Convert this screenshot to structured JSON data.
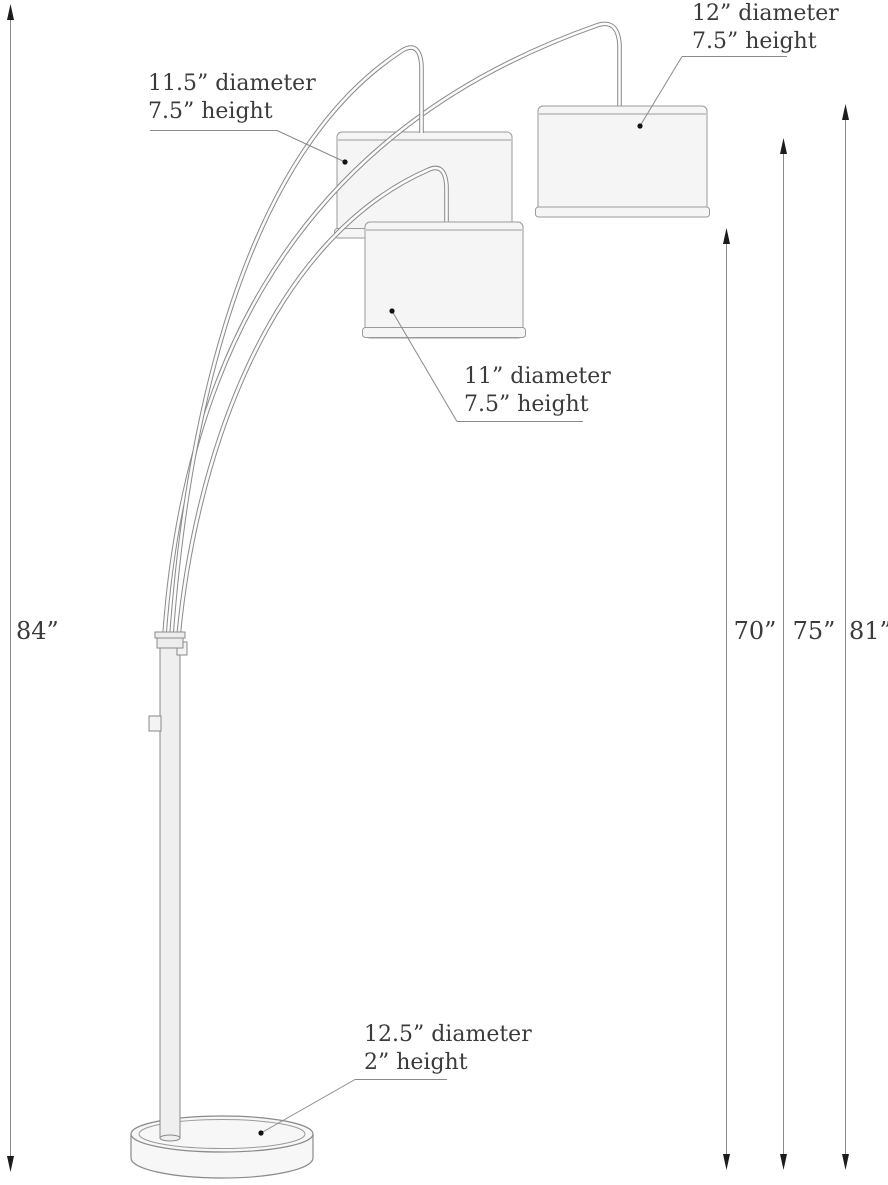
{
  "figure": {
    "kind": "product-dimension-diagram",
    "subject": "three-arc floor lamp with drum shades and round base",
    "colors": {
      "outline": "#8a8a8a",
      "shade_fill": "#f5f5f5",
      "metal_fill": "#efefef",
      "base_fill": "#f7f7f7",
      "text": "#3b3b3b",
      "arrowhead": "#1c1c1c",
      "background": "#ffffff"
    }
  },
  "callouts": {
    "shade_left": {
      "line1": "11.5” diameter",
      "line2": "7.5” height"
    },
    "shade_right": {
      "line1": "12” diameter",
      "line2": "7.5” height"
    },
    "shade_middle": {
      "line1": "11” diameter",
      "line2": "7.5” height"
    },
    "base": {
      "line1": "12.5” diameter",
      "line2": "2” height"
    }
  },
  "dimensions": {
    "overall_height": "84”",
    "middle_shade_height": "70”",
    "left_shade_height": "75”",
    "right_shade_height": "81”"
  }
}
